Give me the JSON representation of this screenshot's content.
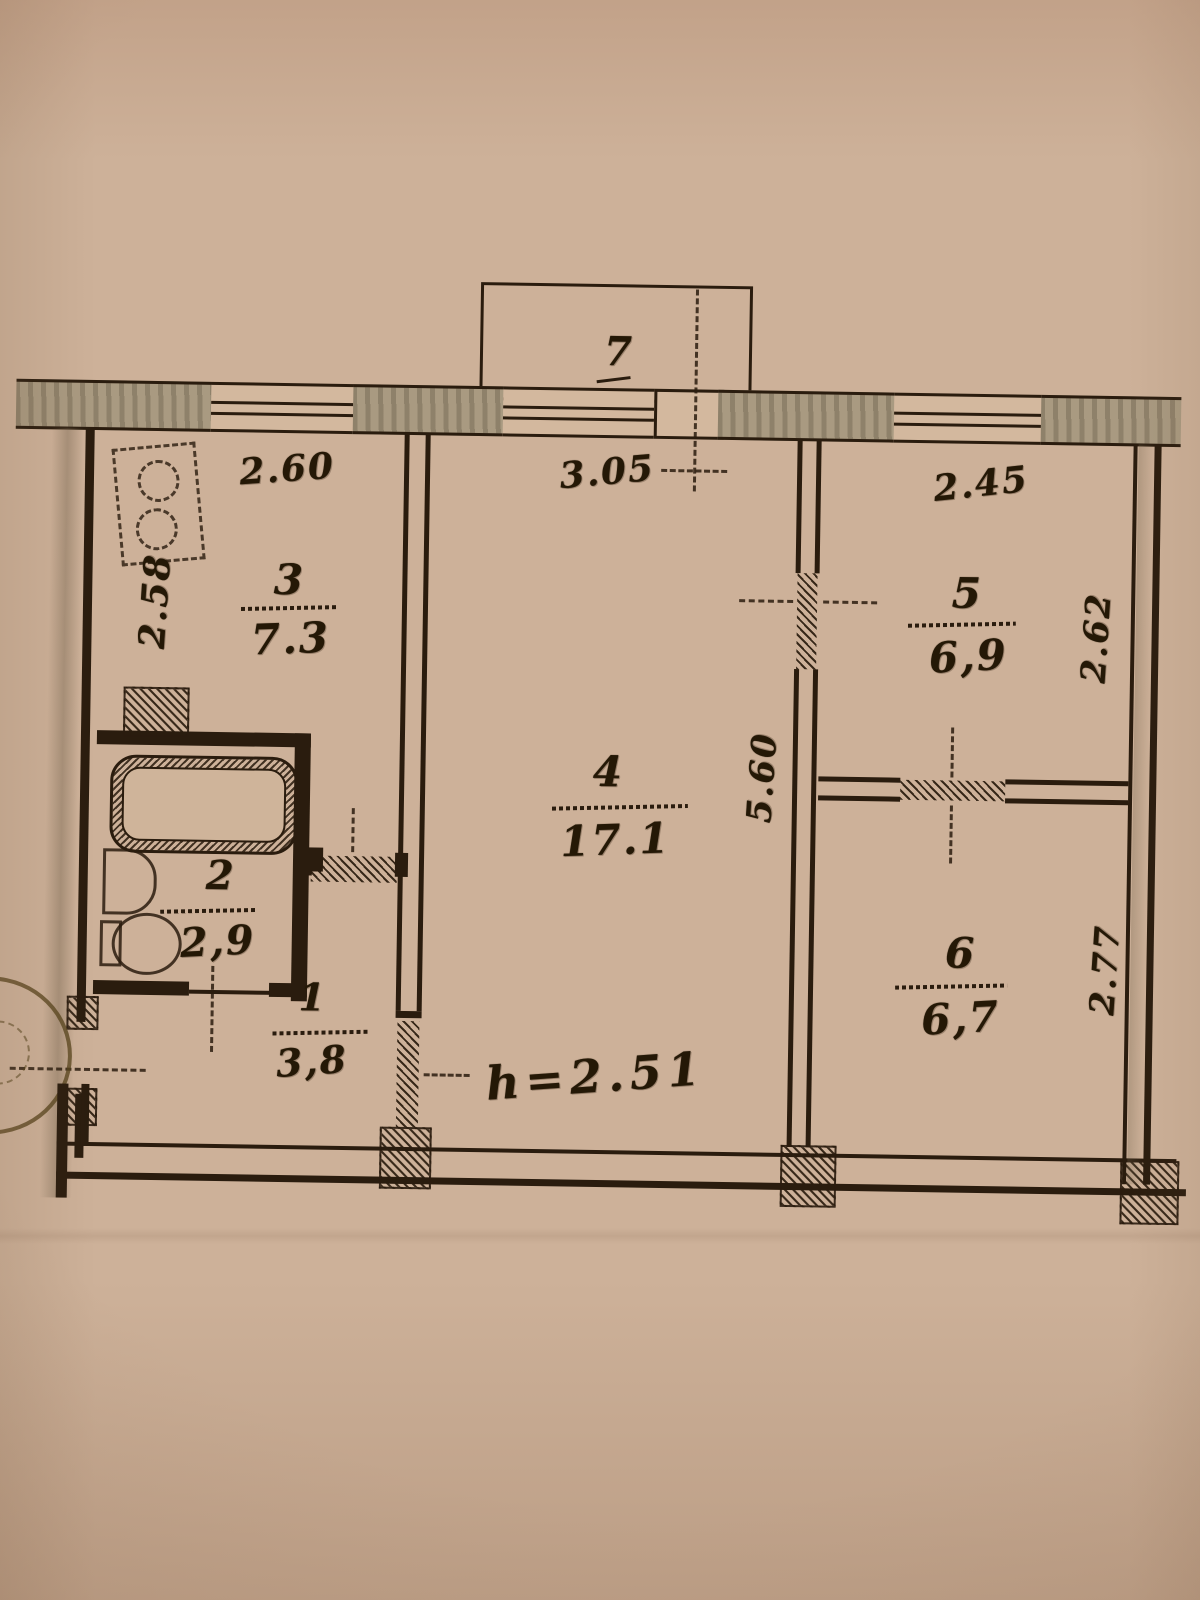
{
  "document": {
    "type": "apartment-floor-plan-scan",
    "paper_color": "#cdb199",
    "ink_color": "#2a1c0e",
    "wall_fill_color": "#a99a81"
  },
  "balcony": {
    "number": "7"
  },
  "rooms": [
    {
      "id": "room-1-hall",
      "number": "1",
      "area": "3,8"
    },
    {
      "id": "room-2-bath",
      "number": "2",
      "area": "2,9"
    },
    {
      "id": "room-3-kitchen",
      "number": "3",
      "area": "7.3"
    },
    {
      "id": "room-4-living",
      "number": "4",
      "area": "17.1"
    },
    {
      "id": "room-5",
      "number": "5",
      "area": "6,9"
    },
    {
      "id": "room-6",
      "number": "6",
      "area": "6,7"
    }
  ],
  "dimensions": {
    "top_left": "2.60",
    "top_center": "3.05",
    "top_right": "2.45",
    "left_vertical": "2.58",
    "center_vertical": "5.60",
    "right_upper_vertical": "2.62",
    "right_lower_vertical": "2.77",
    "ceiling_height": "h=2.51"
  },
  "fixtures": {
    "bathtub": "bathtub",
    "toilet": "toilet",
    "sink": "sink",
    "stove": "stove-burners",
    "vent_shaft": "ventilation-shaft",
    "stamp": "round-stamp-fragment"
  }
}
